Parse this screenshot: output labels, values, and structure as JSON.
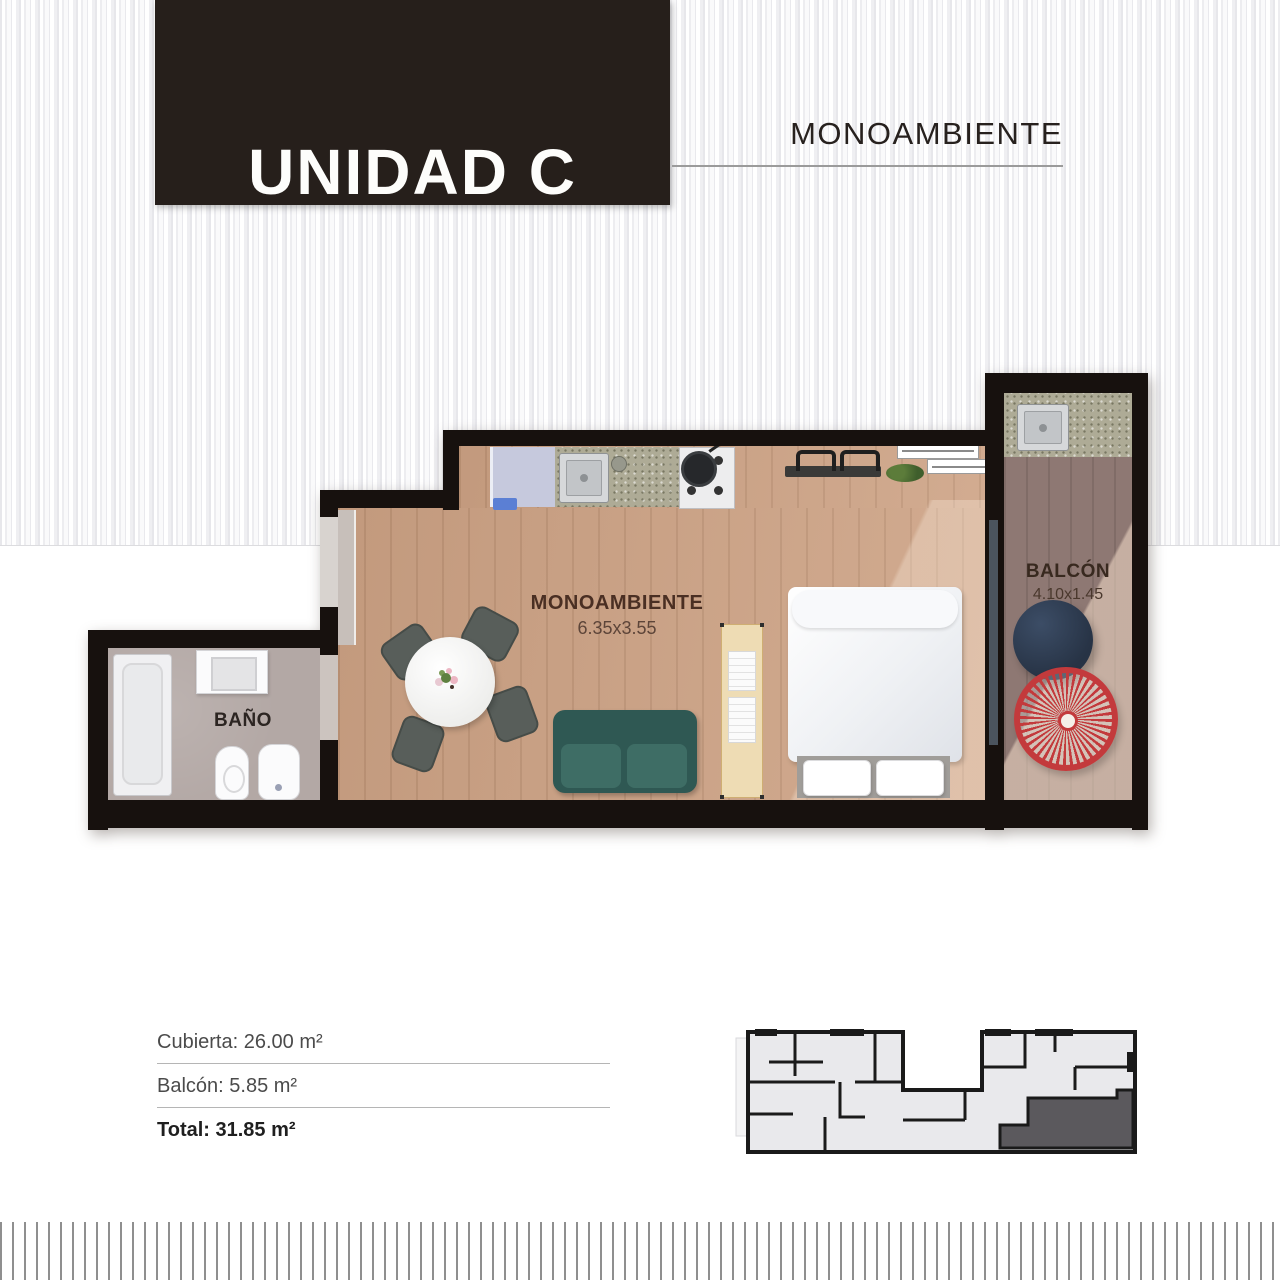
{
  "header": {
    "unit_title": "UNIDAD C",
    "unit_type": "MONOAMBIENTE"
  },
  "plan": {
    "main_room": {
      "label": "MONOAMBIENTE",
      "dims": "6.35x3.55"
    },
    "balcony": {
      "label": "BALCÓN",
      "dims": "4.10x1.45"
    },
    "bathroom": {
      "label": "BAÑO"
    }
  },
  "areas": {
    "covered": "Cubierta: 26.00 m²",
    "balcony": "Balcón: 5.85 m²",
    "total": "Total: 31.85 m²"
  },
  "colors": {
    "header_bg": "#261f1b",
    "wall": "#17110e",
    "wood_floor": "#cda284",
    "balcony_deck": "#8e7873",
    "bath_floor": "#b3a8a5",
    "sofa": "#2f5853",
    "accent_chair": "#c33a3c",
    "navy_table": "#273345",
    "key_plan_highlight": "#5b595d"
  }
}
